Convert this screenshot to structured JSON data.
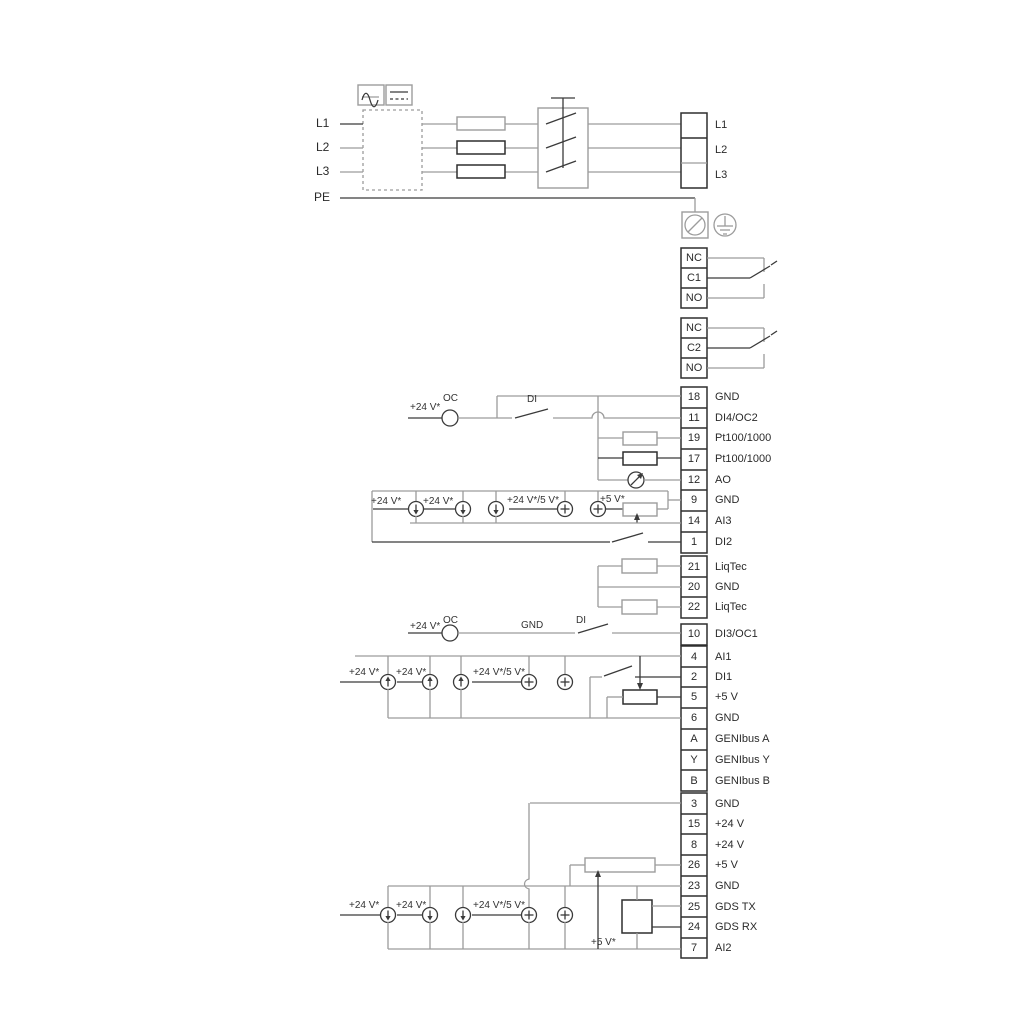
{
  "power": {
    "input_labels": [
      "L1",
      "L2",
      "L3"
    ],
    "pe_label": "PE",
    "output_terminals": [
      "L1",
      "L2",
      "L3"
    ]
  },
  "relay1": {
    "nc": "NC",
    "c": "C1",
    "no": "NO"
  },
  "relay2": {
    "nc": "NC",
    "c": "C2",
    "no": "NO"
  },
  "terminals": [
    {
      "n": "18",
      "label": "GND"
    },
    {
      "n": "11",
      "label": "DI4/OC2"
    },
    {
      "n": "19",
      "label": "Pt100/1000"
    },
    {
      "n": "17",
      "label": "Pt100/1000"
    },
    {
      "n": "12",
      "label": "AO"
    },
    {
      "n": "9",
      "label": "GND"
    },
    {
      "n": "14",
      "label": "AI3"
    },
    {
      "n": "1",
      "label": "DI2"
    },
    {
      "n": "21",
      "label": "LiqTec"
    },
    {
      "n": "20",
      "label": "GND"
    },
    {
      "n": "22",
      "label": "LiqTec"
    },
    {
      "n": "10",
      "label": "DI3/OC1"
    },
    {
      "n": "4",
      "label": "AI1"
    },
    {
      "n": "2",
      "label": "DI1"
    },
    {
      "n": "5",
      "label": "+5 V"
    },
    {
      "n": "6",
      "label": "GND"
    },
    {
      "n": "A",
      "label": "GENIbus A"
    },
    {
      "n": "Y",
      "label": "GENIbus Y"
    },
    {
      "n": "B",
      "label": "GENIbus B"
    },
    {
      "n": "3",
      "label": "GND"
    },
    {
      "n": "15",
      "label": "+24 V"
    },
    {
      "n": "8",
      "label": "+24 V"
    },
    {
      "n": "26",
      "label": "+5 V"
    },
    {
      "n": "23",
      "label": "GND"
    },
    {
      "n": "25",
      "label": "GDS TX"
    },
    {
      "n": "24",
      "label": "GDS RX"
    },
    {
      "n": "7",
      "label": "AI2"
    }
  ],
  "annotations": {
    "oc": "OC",
    "di": "DI",
    "gnd": "GND",
    "v24": "+24 V*",
    "v24_5": "+24 V*/5 V*",
    "v5": "+5 V*"
  },
  "colors": {
    "wire_gray": "#9c9c9c",
    "wire_dark": "#3a3a3a",
    "text": "#2a2a2a"
  }
}
